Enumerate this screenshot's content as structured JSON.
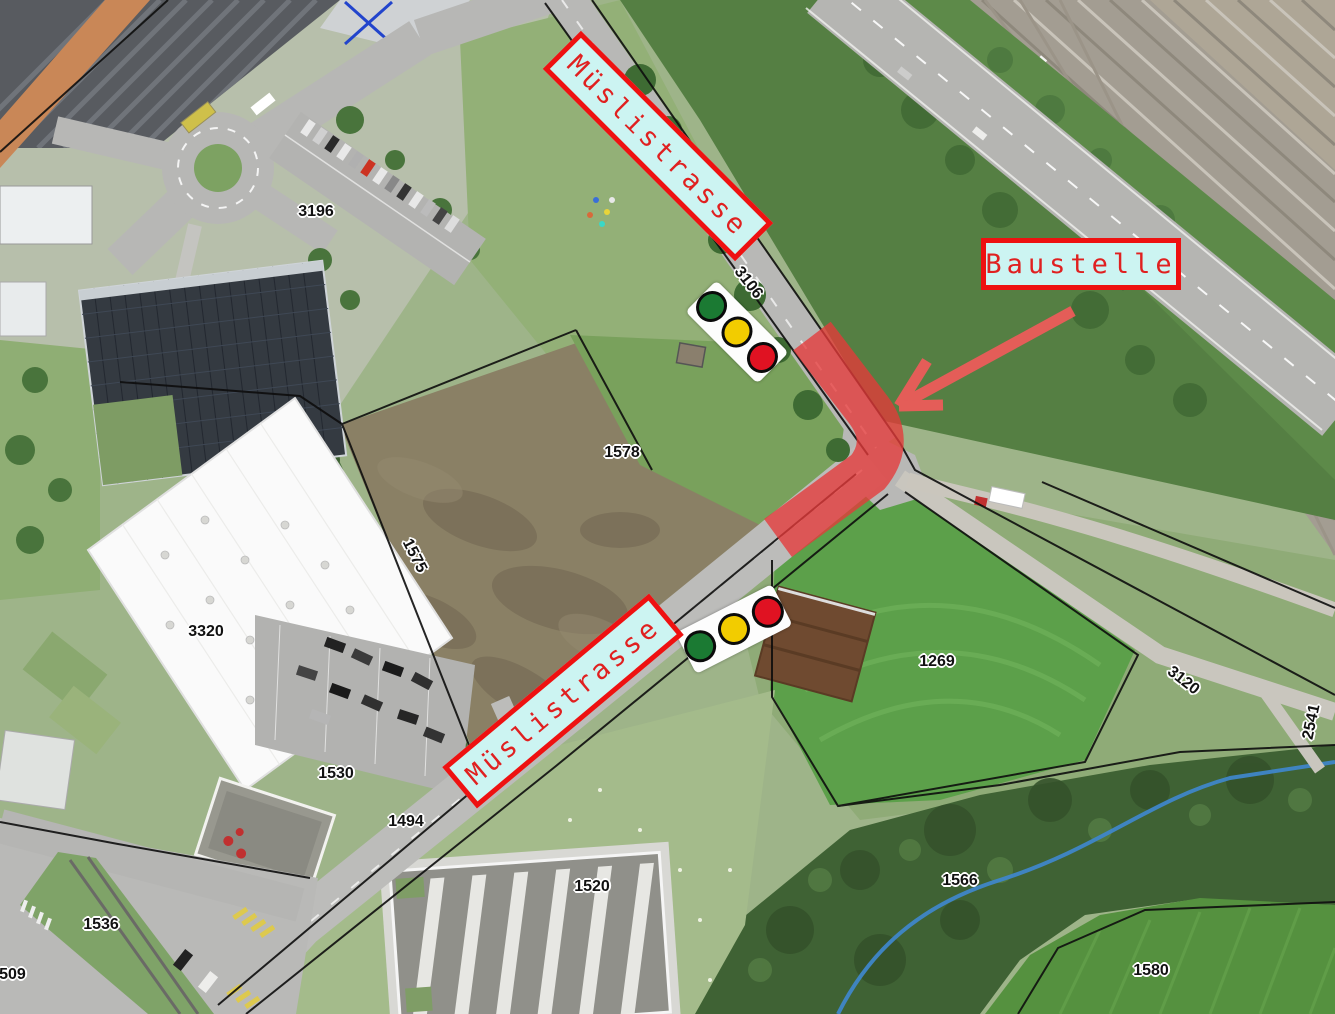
{
  "annotations": {
    "street_labels": [
      {
        "id": "muslistrasse-upper",
        "text": "Müslistrasse"
      },
      {
        "id": "muslistrasse-lower",
        "text": "Müslistrasse"
      }
    ],
    "construction_label": {
      "text": "Baustelle"
    },
    "parcels": [
      {
        "text": "3196"
      },
      {
        "text": "3106"
      },
      {
        "text": "1578"
      },
      {
        "text": "1575"
      },
      {
        "text": "3320"
      },
      {
        "text": "1530"
      },
      {
        "text": "1494"
      },
      {
        "text": "1536"
      },
      {
        "text": "4509"
      },
      {
        "text": "1520"
      },
      {
        "text": "1269"
      },
      {
        "text": "1566"
      },
      {
        "text": "1580"
      },
      {
        "text": "3120"
      },
      {
        "text": "2541"
      }
    ]
  },
  "traffic_lights": [
    {
      "id": "north-signal",
      "lamps": [
        "green",
        "yellow",
        "red"
      ]
    },
    {
      "id": "south-signal",
      "lamps": [
        "green",
        "yellow",
        "red"
      ]
    }
  ],
  "colors": {
    "annotation_red": "#ee1111",
    "annotation_text_red": "#e02020",
    "label_bg": "#ccf4f2",
    "zone_red": "#e63a3a",
    "arrow_red": "#f15b5b",
    "tl_green": "#1b7a33",
    "tl_yellow": "#f2cc00",
    "tl_red": "#e01222",
    "parcel_text": "#111111"
  }
}
